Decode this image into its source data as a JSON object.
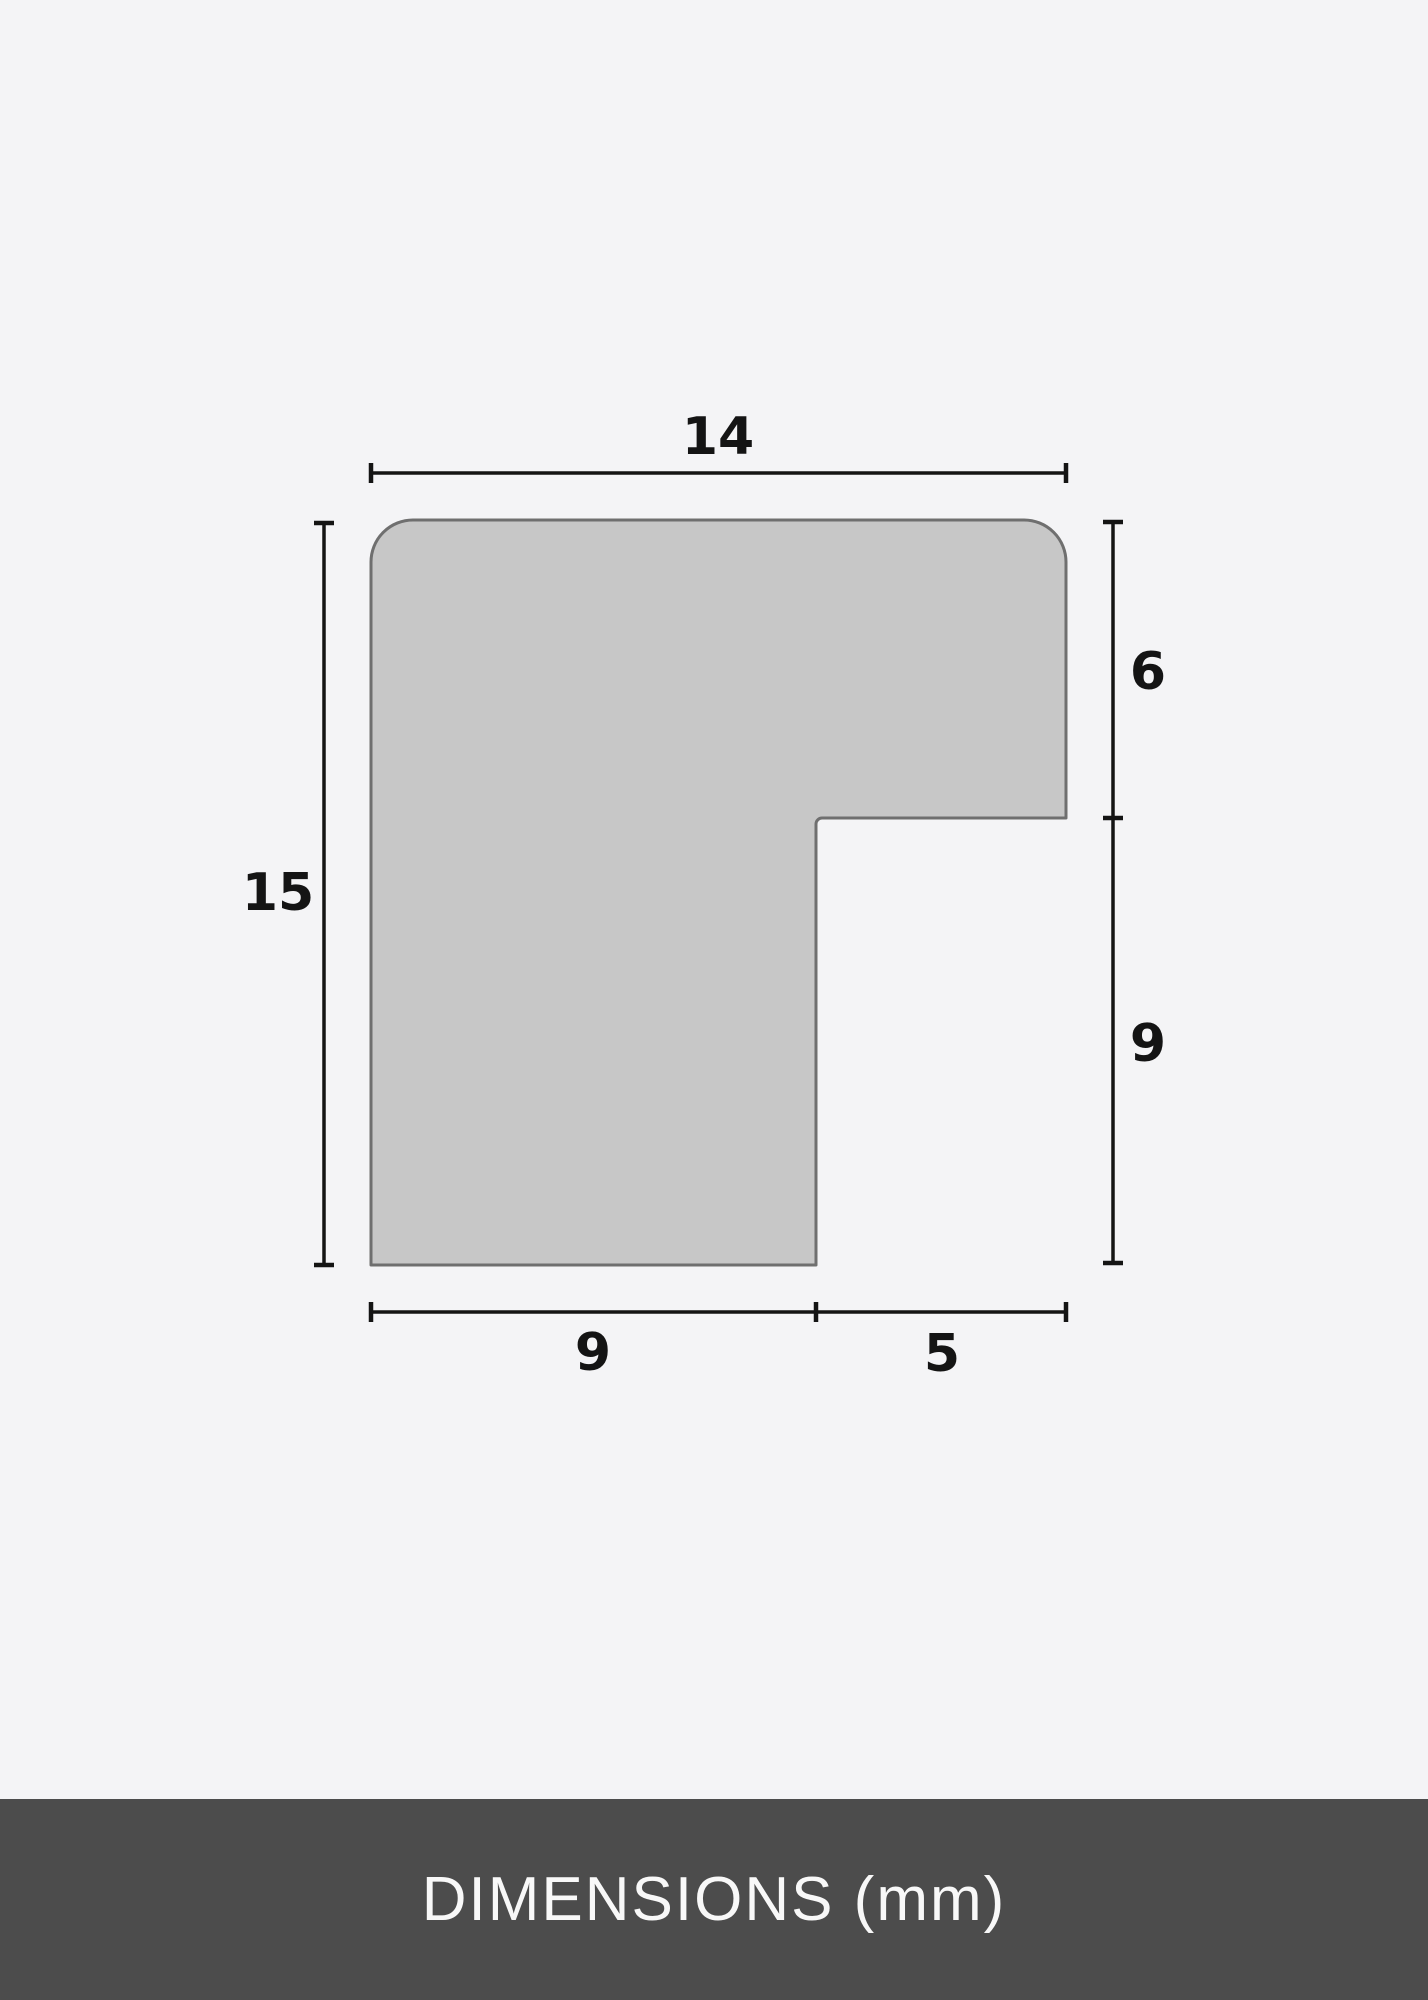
{
  "diagram": {
    "description": "frame moulding profile cross-section",
    "unit": "mm",
    "dimensions": {
      "top_width": {
        "label": "14",
        "value": 14,
        "edge": "overall width (top)"
      },
      "left_height": {
        "label": "15",
        "value": 15,
        "edge": "overall height (left)"
      },
      "right_upper": {
        "label": "6",
        "value": 6,
        "edge": "top bar thickness (right upper)"
      },
      "right_lower": {
        "label": "9",
        "value": 9,
        "edge": "rabbet depth (right lower)"
      },
      "bottom_left": {
        "label": "9",
        "value": 9,
        "edge": "column width (bottom left)"
      },
      "bottom_right": {
        "label": "5",
        "value": 5,
        "edge": "rabbet width (bottom right)"
      }
    }
  },
  "footer": {
    "title": "DIMENSIONS (mm)"
  },
  "colors": {
    "background": "#f4f4f6",
    "shape_fill": "#c7c7c7",
    "shape_stroke": "#6f6f6f",
    "dimension_line": "#141414",
    "label_color": "#141414",
    "footer_background": "#4c4c4c",
    "footer_text": "#f8f8f8"
  }
}
